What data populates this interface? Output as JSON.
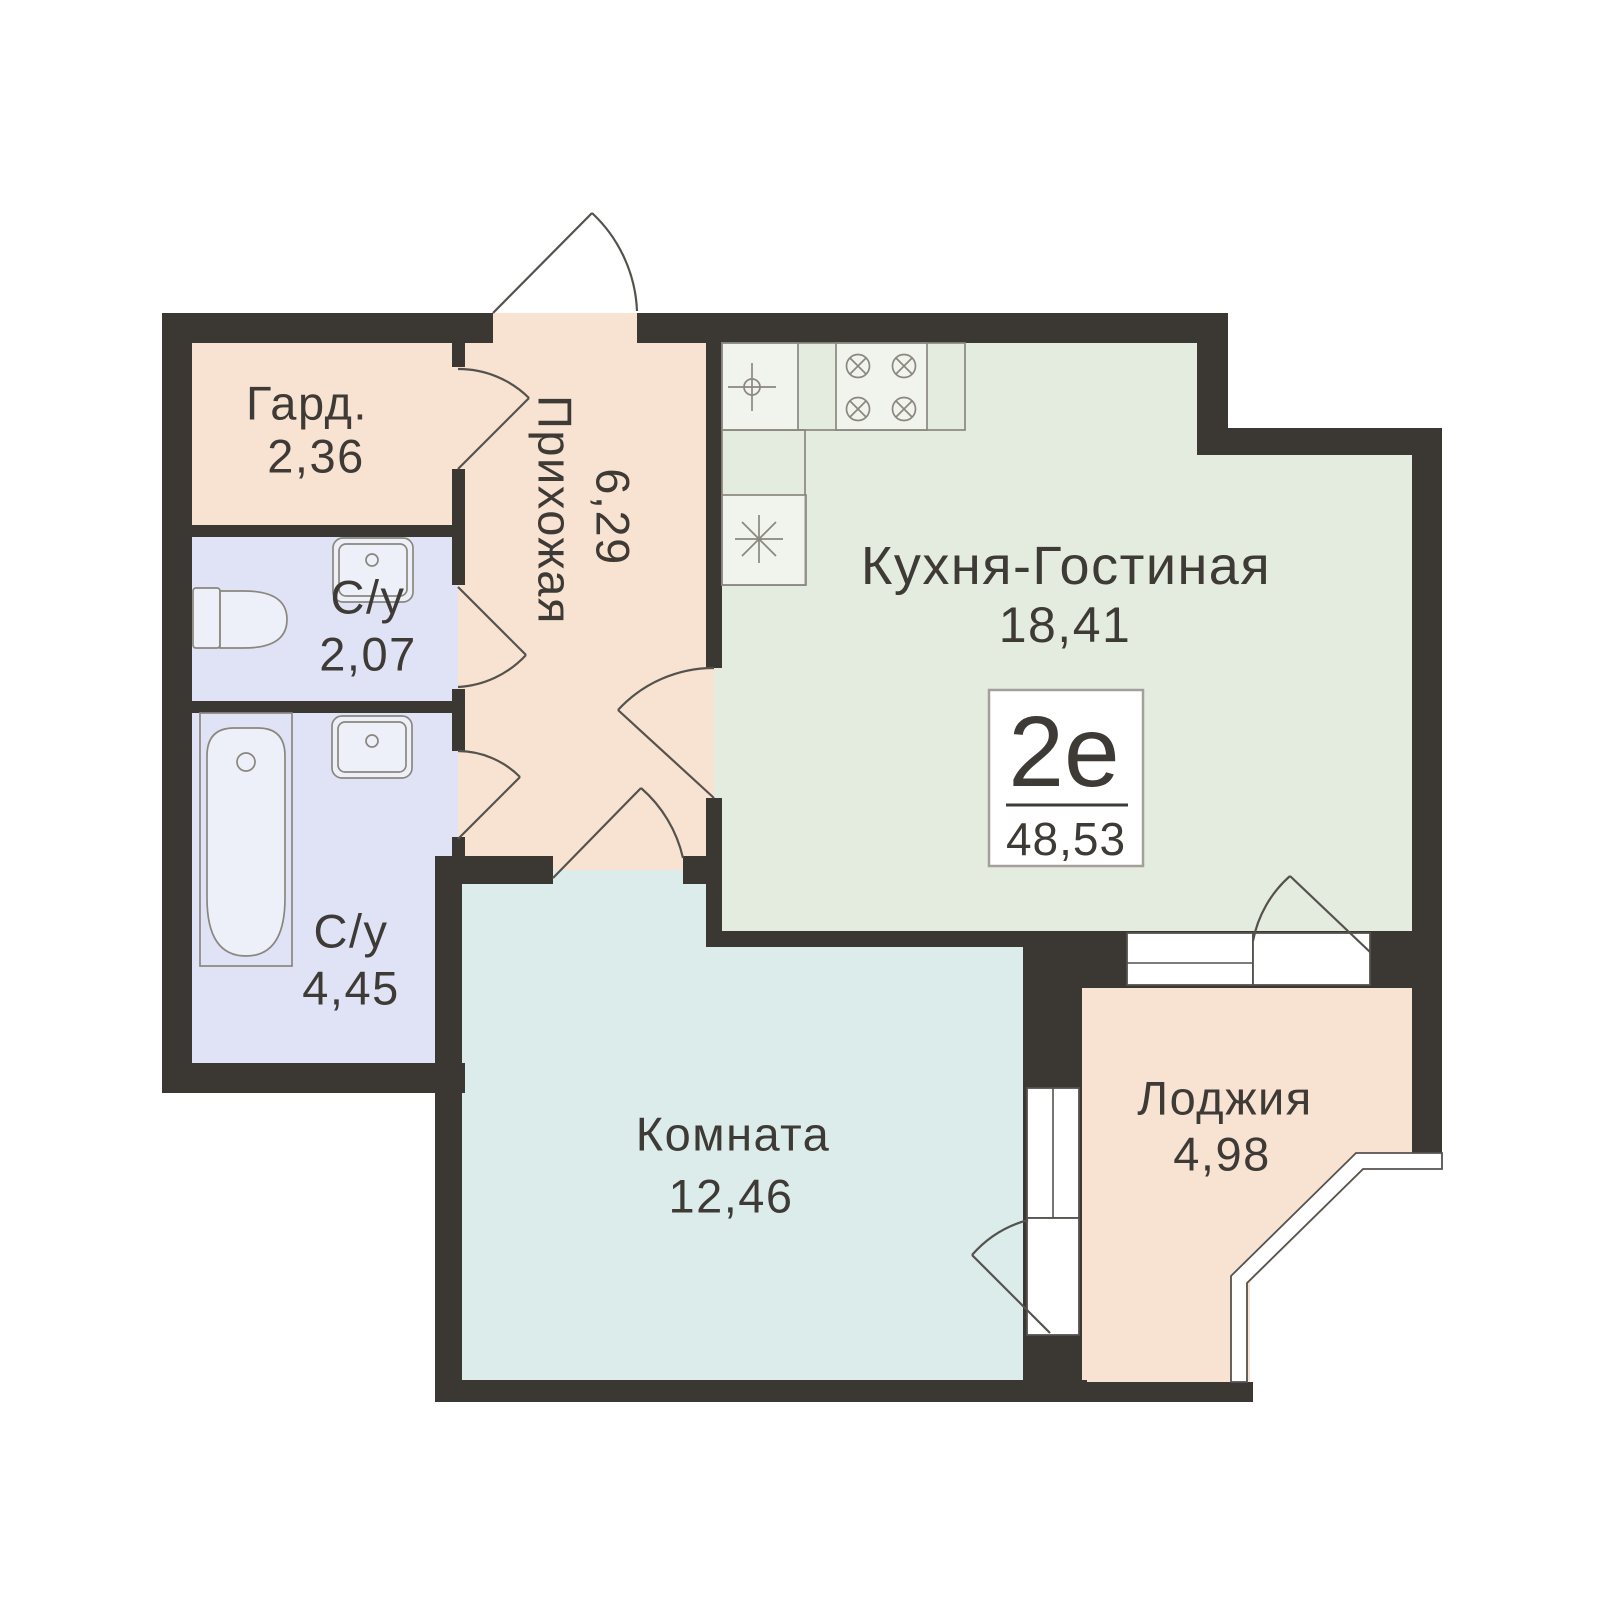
{
  "plan": {
    "badge": {
      "type_label": "2е",
      "total_area": "48,53"
    },
    "rooms": [
      {
        "id": "wardrobe",
        "label": "Гард.",
        "area": "2,36"
      },
      {
        "id": "bathroom-small",
        "label": "С/у",
        "area": "2,07"
      },
      {
        "id": "bathroom-large",
        "label": "С/у",
        "area": "4,45"
      },
      {
        "id": "hallway",
        "label": "Прихожая",
        "area": "6,29"
      },
      {
        "id": "kitchen-living",
        "label": "Кухня-Гостиная",
        "area": "18,41"
      },
      {
        "id": "room",
        "label": "Комната",
        "area": "12,46"
      },
      {
        "id": "loggia",
        "label": "Лоджия",
        "area": "4,98"
      }
    ],
    "fixtures": [
      "toilet",
      "bathtub",
      "sink",
      "kitchen-sink",
      "stove",
      "fridge"
    ],
    "colors": {
      "background": "#ffffff",
      "wall": "#3b3733",
      "peach": "#f8e3d2",
      "lavender": "#dfe3f5",
      "green": "#e4ecdf",
      "cyan": "#dbeceb",
      "outline": "#55524e",
      "fixture_line": "#8b877f",
      "text": "#3e3a36",
      "badge_border": "#a3a09c"
    }
  }
}
